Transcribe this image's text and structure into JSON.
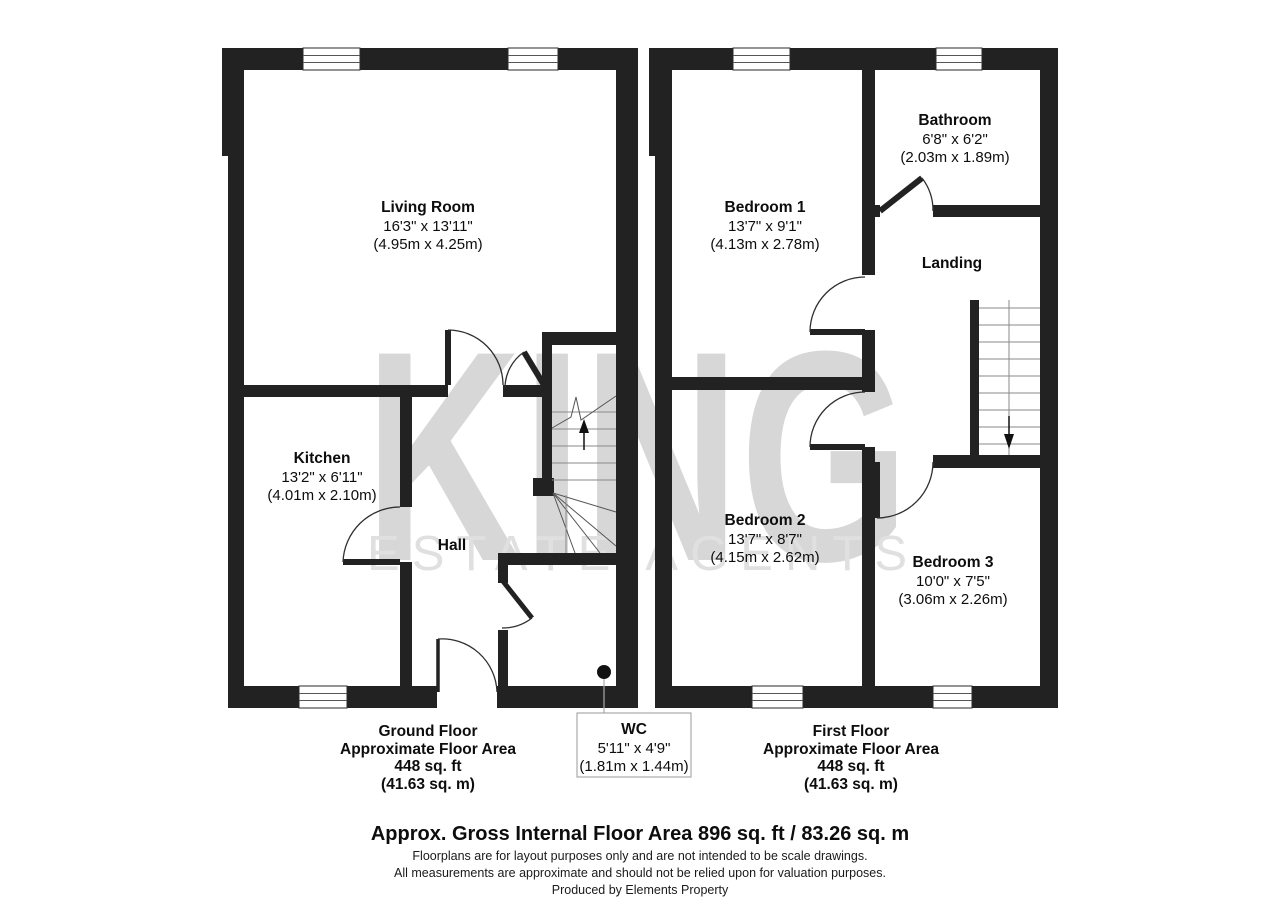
{
  "watermark": {
    "brand": "KING",
    "tagline": "ESTATE AGENTS",
    "color": "#d7d7d7"
  },
  "ground_floor": {
    "rooms": {
      "living_room": {
        "name": "Living Room",
        "imperial": "16'3\" x 13'11\"",
        "metric": "(4.95m x 4.25m)"
      },
      "kitchen": {
        "name": "Kitchen",
        "imperial": "13'2\" x 6'11\"",
        "metric": "(4.01m x 2.10m)"
      },
      "hall": {
        "name": "Hall"
      },
      "wc": {
        "name": "WC",
        "imperial": "5'11\" x 4'9\"",
        "metric": "(1.81m x 1.44m)"
      }
    },
    "caption": {
      "title": "Ground Floor",
      "line2": "Approximate Floor Area",
      "line3": "448 sq. ft",
      "line4": "(41.63 sq. m)"
    }
  },
  "first_floor": {
    "rooms": {
      "bedroom1": {
        "name": "Bedroom 1",
        "imperial": "13'7\" x 9'1\"",
        "metric": "(4.13m x 2.78m)"
      },
      "bathroom": {
        "name": "Bathroom",
        "imperial": "6'8\" x 6'2\"",
        "metric": "(2.03m x 1.89m)"
      },
      "landing": {
        "name": "Landing"
      },
      "bedroom2": {
        "name": "Bedroom 2",
        "imperial": "13'7\" x 8'7\"",
        "metric": "(4.15m x 2.62m)"
      },
      "bedroom3": {
        "name": "Bedroom 3",
        "imperial": "10'0\" x 7'5\"",
        "metric": "(3.06m x 2.26m)"
      }
    },
    "caption": {
      "title": "First Floor",
      "line2": "Approximate Floor Area",
      "line3": "448 sq. ft",
      "line4": "(41.63 sq. m)"
    }
  },
  "footer": {
    "total": "Approx. Gross Internal Floor Area 896 sq. ft / 83.26 sq. m",
    "disclaimer1": "Floorplans are for layout purposes only and are not intended to be scale drawings.",
    "disclaimer2": "All measurements are approximate and should not be relied upon for valuation purposes.",
    "credit": "Produced by Elements Property"
  }
}
